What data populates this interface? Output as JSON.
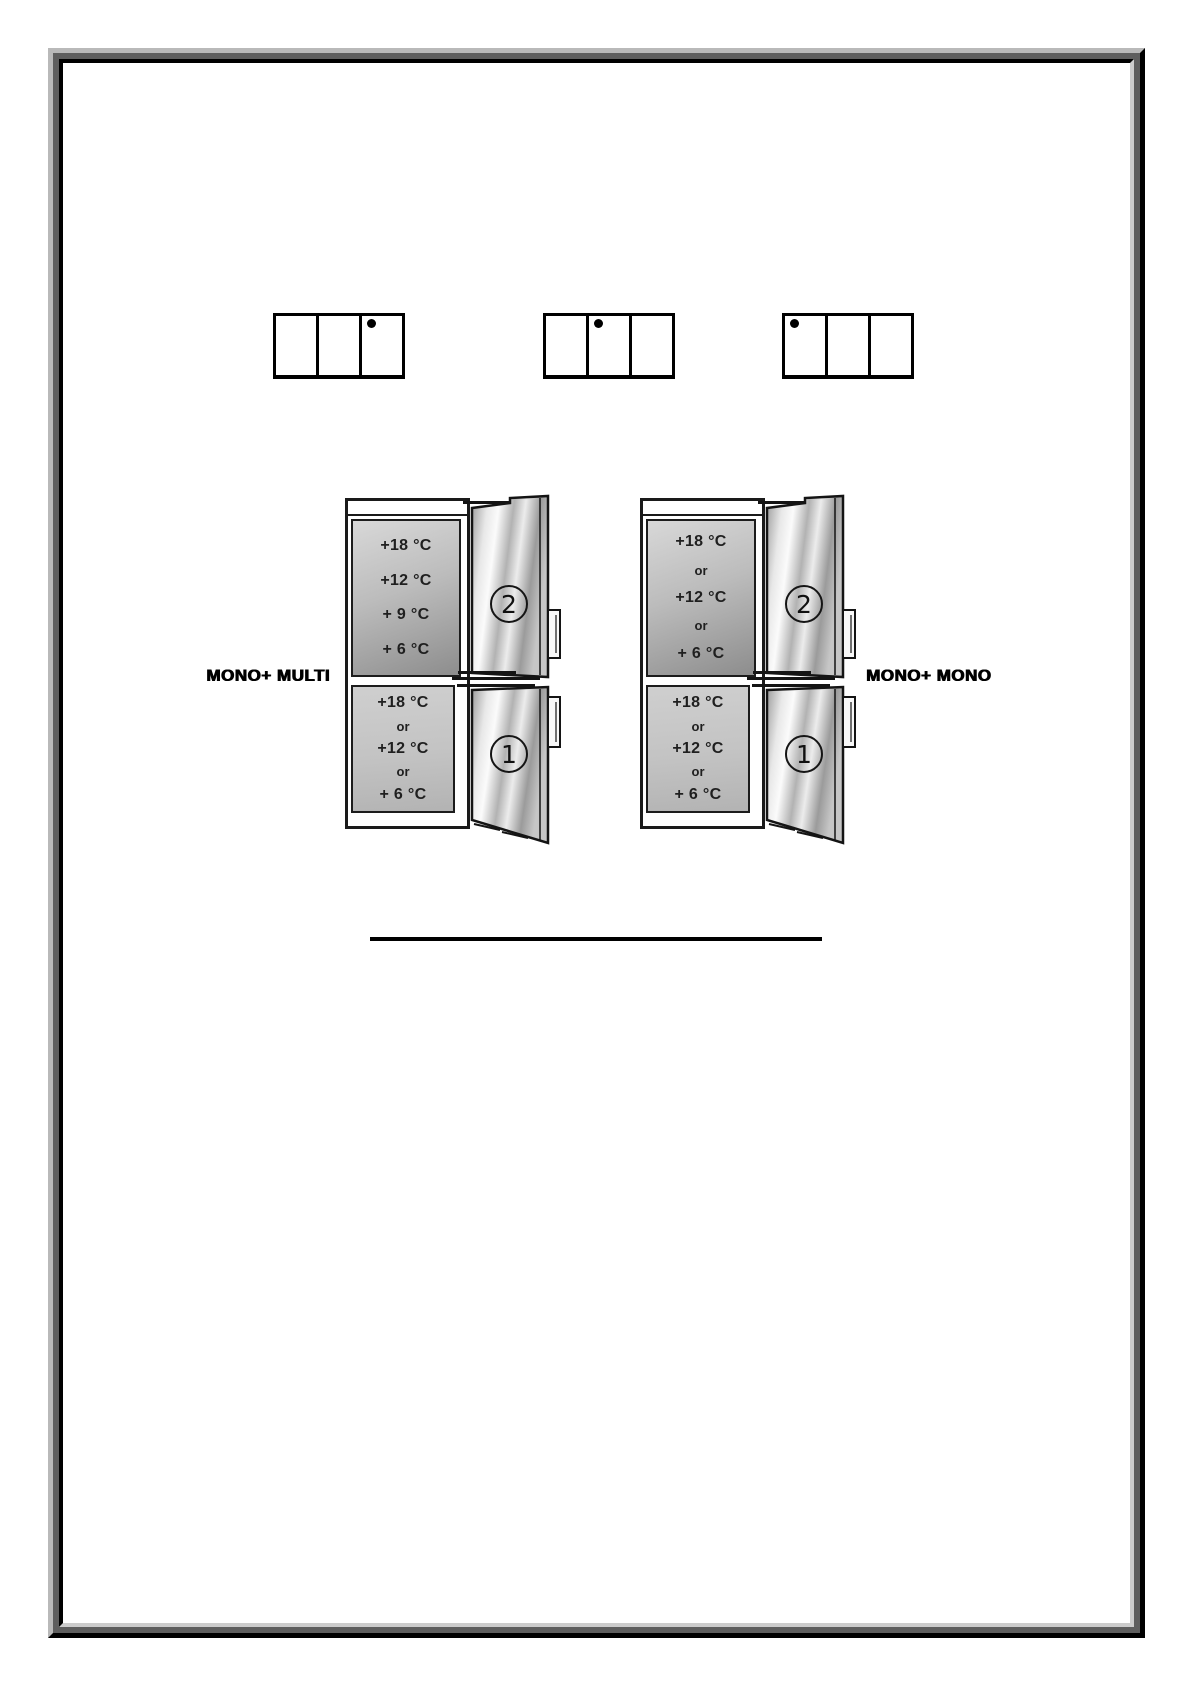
{
  "page": {
    "background": "#ffffff",
    "frame_colors": {
      "outer_light": "#b9b9b9",
      "mid_gray": "#5e5e5e",
      "black": "#000000",
      "inner_light": "#cccccc"
    }
  },
  "selectors": [
    {
      "cells": 3,
      "dot_cell": 3
    },
    {
      "cells": 3,
      "dot_cell": 2
    },
    {
      "cells": 3,
      "dot_cell": 1
    }
  ],
  "diagrams": [
    {
      "label": "MONO+ MULTI",
      "label_side": "left",
      "compartments": {
        "top": {
          "lines": [
            "+18 °C",
            "+12 °C",
            "+ 9 °C",
            "+ 6 °C"
          ],
          "door_number": "2"
        },
        "bottom": {
          "lines": [
            "+18 °C",
            "or",
            "+12 °C",
            "or",
            "+ 6 °C"
          ],
          "door_number": "1"
        }
      }
    },
    {
      "label": "MONO+ MONO",
      "label_side": "right",
      "compartments": {
        "top": {
          "lines": [
            "+18 °C",
            "or",
            "+12 °C",
            "or",
            "+ 6 °C"
          ],
          "door_number": "2"
        },
        "bottom": {
          "lines": [
            "+18 °C",
            "or",
            "+12 °C",
            "or",
            "+ 6 °C"
          ],
          "door_number": "1"
        }
      }
    }
  ],
  "colors": {
    "panel_border": "#1c1c1c",
    "top_panel_dark_gray": "#8d8d8d",
    "top_panel_light_gray": "#d8d8d8",
    "bottom_panel_gray": "#c3c3c3",
    "line_black": "#000000"
  }
}
